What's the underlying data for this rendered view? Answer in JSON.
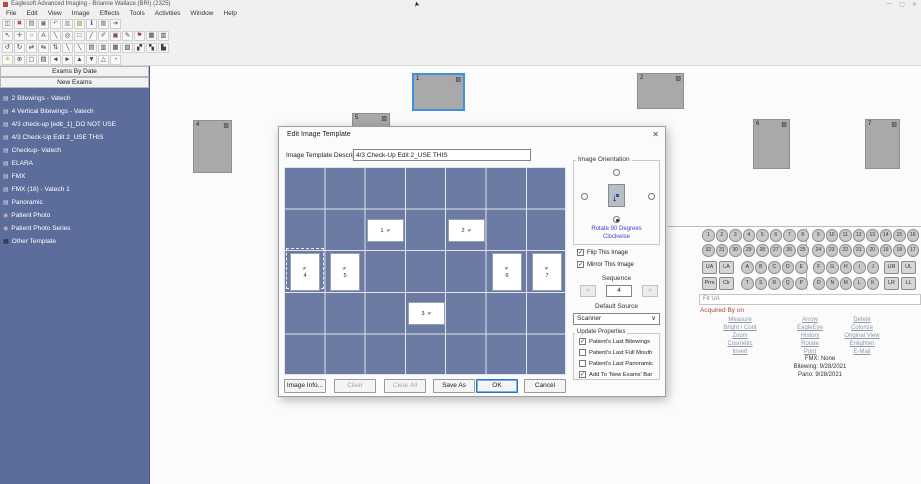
{
  "window": {
    "title": "Eaglesoft Advanced Imaging - Brianne Wallace (BRI) (2325)",
    "controls": {
      "minimize": "—",
      "maximize": "▢",
      "close": "✕"
    },
    "cursor_glyph": "➤"
  },
  "menu": {
    "items": [
      "File",
      "Edit",
      "View",
      "Image",
      "Effects",
      "Tools",
      "Activities",
      "Window",
      "Help"
    ]
  },
  "toolbar": {
    "row1": [
      {
        "name": "save-icon",
        "glyph": "◫",
        "color": "#3a4f86"
      },
      {
        "name": "delete-icon",
        "glyph": "✖",
        "color": "#c03030"
      },
      {
        "name": "print-icon",
        "glyph": "▤",
        "color": "#666666"
      },
      {
        "name": "acquire-icon",
        "glyph": "▣",
        "color": "#777777"
      },
      {
        "name": "undo-icon",
        "glyph": "↶",
        "color": "#888888"
      },
      {
        "name": "copy-icon",
        "glyph": "▥",
        "color": "#888888"
      },
      {
        "name": "paste-icon",
        "glyph": "▧",
        "color": "#a08a50"
      },
      {
        "name": "info-icon",
        "glyph": "ℹ",
        "color": "#1840c0"
      },
      {
        "name": "layout-icon",
        "glyph": "▦",
        "color": "#888888"
      },
      {
        "name": "exit-icon",
        "glyph": "➜",
        "color": "#2a8a2a"
      }
    ],
    "row2": [
      {
        "name": "pointer-icon",
        "glyph": "↖",
        "color": "#404040"
      },
      {
        "name": "pan-icon",
        "glyph": "✛",
        "color": "#404040"
      },
      {
        "name": "magnify-icon",
        "glyph": "○",
        "color": "#404040"
      },
      {
        "name": "text-tool-icon",
        "glyph": "A",
        "color": "#404040"
      },
      {
        "name": "line-tool-icon",
        "glyph": "╲",
        "color": "#404040"
      },
      {
        "name": "ellipse-tool-icon",
        "glyph": "◎",
        "color": "#404040"
      },
      {
        "name": "rectangle-tool-icon",
        "glyph": "□",
        "color": "#404040"
      },
      {
        "name": "pen-tool-icon",
        "glyph": "╱",
        "color": "#404040"
      },
      {
        "name": "marker-tool-icon",
        "glyph": "✐",
        "color": "#606060"
      },
      {
        "name": "stamp-tool-icon",
        "glyph": "▣",
        "color": "#705050"
      },
      {
        "name": "pencil-tool-icon",
        "glyph": "✎",
        "color": "#404040"
      },
      {
        "name": "flag-tool-icon",
        "glyph": "⚑",
        "color": "#a03030"
      },
      {
        "name": "grid-tool-icon",
        "glyph": "▦",
        "color": "#404040"
      },
      {
        "name": "frame-tool-icon",
        "glyph": "▥",
        "color": "#404040"
      }
    ],
    "row3": [
      {
        "name": "rotate-ccw-icon",
        "glyph": "↺",
        "color": "#404040"
      },
      {
        "name": "rotate-cw-icon",
        "glyph": "↻",
        "color": "#404040"
      },
      {
        "name": "rotate-180-icon",
        "glyph": "⇄",
        "color": "#404040"
      },
      {
        "name": "flip-horizontal-icon",
        "glyph": "⇆",
        "color": "#404040"
      },
      {
        "name": "flip-vertical-icon",
        "glyph": "⇅",
        "color": "#404040"
      },
      {
        "name": "measure-line-icon",
        "glyph": "╲",
        "color": "#404040"
      },
      {
        "name": "annotate-line-icon",
        "glyph": "╲",
        "color": "#404040"
      },
      {
        "name": "tile-single-icon",
        "glyph": "▤",
        "color": "#404040"
      },
      {
        "name": "tile-double-icon",
        "glyph": "▥",
        "color": "#404040"
      },
      {
        "name": "tile-quad-icon",
        "glyph": "▦",
        "color": "#404040"
      },
      {
        "name": "tile-grid-icon",
        "glyph": "▧",
        "color": "#404040"
      },
      {
        "name": "compare-icon",
        "glyph": "▞",
        "color": "#404040"
      },
      {
        "name": "series-icon",
        "glyph": "▚",
        "color": "#404040"
      },
      {
        "name": "chart-icon",
        "glyph": "▙",
        "color": "#404040"
      }
    ],
    "row4": [
      {
        "name": "enhance-icon",
        "glyph": "✳",
        "color": "#c8a800"
      },
      {
        "name": "zoom-in-icon",
        "glyph": "⊕",
        "color": "#404040"
      },
      {
        "name": "crop-icon",
        "glyph": "▢",
        "color": "#404040"
      },
      {
        "name": "preview-icon",
        "glyph": "▤",
        "color": "#404040"
      },
      {
        "name": "back-icon",
        "glyph": "◄",
        "color": "#404040"
      },
      {
        "name": "forward-icon",
        "glyph": "►",
        "color": "#404040"
      },
      {
        "name": "up-icon",
        "glyph": "▲",
        "color": "#404040"
      },
      {
        "name": "down-icon",
        "glyph": "▼",
        "color": "#404040"
      },
      {
        "name": "angle-icon",
        "glyph": "△",
        "color": "#404040"
      },
      {
        "name": "history-icon",
        "glyph": "◔",
        "color": "#404040"
      }
    ]
  },
  "sidebar": {
    "exams_by_date": "Exams By Date",
    "new_exams": "New Exams",
    "items": [
      {
        "label": "2 Bitewings - Vatech",
        "icon": "▤",
        "color": "#ccd2e4"
      },
      {
        "label": "4 Vertical Bitewings - Vatech",
        "icon": "▤",
        "color": "#ccd2e4"
      },
      {
        "label": "4/3 check-up [edit_1]_DO NOT USE",
        "icon": "▤",
        "color": "#ccd2e4"
      },
      {
        "label": "4/3 Check-Up Edit 2_USE THIS",
        "icon": "▤",
        "color": "#ccd2e4"
      },
      {
        "label": "Checkup- Vatech",
        "icon": "▤",
        "color": "#ccd2e4"
      },
      {
        "label": "ELARA",
        "icon": "▤",
        "color": "#ccd2e4"
      },
      {
        "label": "FMX",
        "icon": "▤",
        "color": "#ccd2e4"
      },
      {
        "label": "FMX (18) - Vatech 1",
        "icon": "▤",
        "color": "#ccd2e4"
      },
      {
        "label": "Panoramic",
        "icon": "▤",
        "color": "#ccd2e4"
      },
      {
        "label": "Patient Photo",
        "icon": "◉",
        "color": "#e0a8a0"
      },
      {
        "label": "Patient Photo Series",
        "icon": "◉",
        "color": "#e0a8a0"
      },
      {
        "label": "Other Template",
        "icon": "▦",
        "color": "#1c2438"
      }
    ]
  },
  "canvas": {
    "image_icon": "▨",
    "thumbnails": [
      {
        "n": "4"
      },
      {
        "n": "1"
      },
      {
        "n": "5"
      },
      {
        "n": "2"
      },
      {
        "n": "6"
      },
      {
        "n": "7"
      }
    ]
  },
  "dialog": {
    "title": "Edit Image Template",
    "close": "✕",
    "description_label": "Image Template Description:",
    "description_value": "4/3 Check-Up Edit 2_USE THIS",
    "grid": {
      "tile_icon": "➢",
      "selected_tile": "4",
      "tiles": [
        {
          "n": "1"
        },
        {
          "n": "2"
        },
        {
          "n": "3"
        },
        {
          "n": "4"
        },
        {
          "n": "5"
        },
        {
          "n": "6"
        },
        {
          "n": "7"
        }
      ]
    },
    "orientation": {
      "group_label": "Image Orientation",
      "rotate_link_line1": "Rotate 90 Degrees",
      "rotate_link_line2": "Clockwise",
      "arrow": "↓"
    },
    "flip_label": "Flip This Image",
    "mirror_label": "Mirror This Image",
    "sequence": {
      "label": "Sequence",
      "value": "4",
      "dec": "<",
      "inc": ">"
    },
    "default_source": {
      "label": "Default Source",
      "value": "Scanner",
      "caret": "∨"
    },
    "update_properties": {
      "label": "Update Properties",
      "bitewings": "Patient's Last Bitewings",
      "full_mouth": "Patient's Last Full Mouth",
      "panoramic": "Patient's Last Panoramic",
      "new_exams": "Add To 'New Exams' Bar"
    },
    "buttons": {
      "image_info": "Image Info...",
      "clear": "Clear",
      "clear_all": "Clear All",
      "save_as": "Save As",
      "ok": "OK",
      "cancel": "Cancel"
    }
  },
  "tooth_panel": {
    "upper_teeth": [
      "1",
      "2",
      "3",
      "4",
      "5",
      "6",
      "7",
      "8",
      "9",
      "10",
      "11",
      "12",
      "13",
      "14",
      "15",
      "16"
    ],
    "lower_teeth": [
      "32",
      "31",
      "30",
      "29",
      "28",
      "27",
      "26",
      "25",
      "24",
      "23",
      "22",
      "21",
      "20",
      "19",
      "18",
      "17"
    ],
    "primary_upper": [
      "A",
      "B",
      "C",
      "D",
      "E",
      "F",
      "G",
      "H",
      "I",
      "J"
    ],
    "primary_lower": [
      "T",
      "S",
      "R",
      "Q",
      "P",
      "O",
      "N",
      "M",
      "L",
      "K"
    ],
    "arch_buttons": {
      "ua": "UA",
      "la": "LA",
      "prm": "Prm",
      "clr": "Clr",
      "ur": "UR",
      "ul": "UL",
      "lr": "LR",
      "ll": "LL"
    },
    "position_text": "Fit UA",
    "acquired_text": "Acquired By  on",
    "links_col1": [
      "Measure",
      "Bright / Cont",
      "Zoom",
      "Cosmetic",
      "Invert"
    ],
    "links_col2": [
      "Arrow",
      "EagleEye",
      "History",
      "Rotate",
      "Print"
    ],
    "links_col3": [
      "Delete",
      "Colorize",
      "Original View",
      "Enlighten",
      "E-Mail"
    ],
    "history_lines": [
      "FMX: None",
      "Bitewing: 9/28/2021",
      "Pano: 9/28/2021"
    ]
  }
}
